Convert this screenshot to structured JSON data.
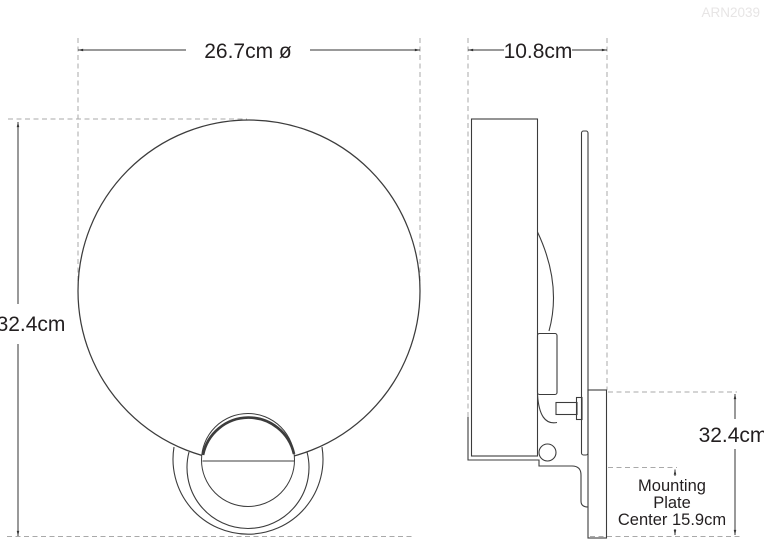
{
  "product_code": "ARN2039",
  "front_view": {
    "diameter_label": "26.7cm ø",
    "height_label": "32.4cm"
  },
  "side_view": {
    "depth_label": "10.8cm",
    "height_label": "32.4cm",
    "mounting_note_lines": [
      "Mounting",
      "Plate",
      "Center 15.9cm"
    ]
  },
  "colors": {
    "line": "#3c3c3c",
    "dimension": "#333333",
    "dashed_extension": "#a9a9a9",
    "text": "#231f20",
    "watermark": "#e7e5e5",
    "background": "#ffffff"
  }
}
